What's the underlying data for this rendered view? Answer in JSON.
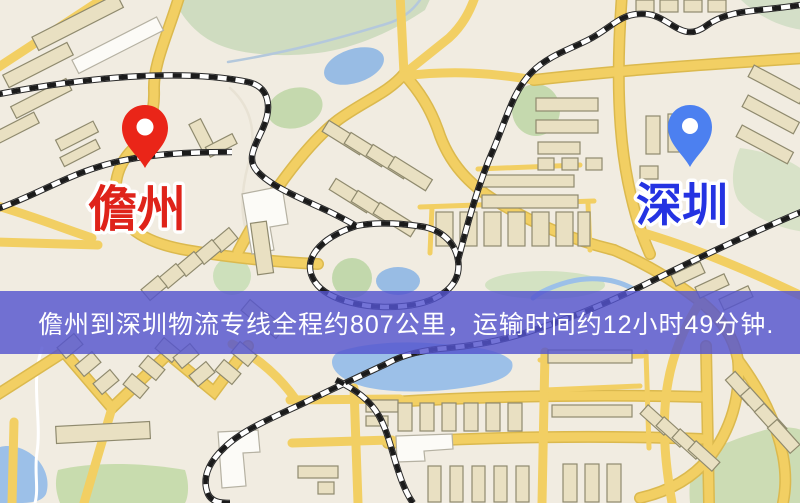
{
  "banner": {
    "text": "儋州到深圳物流专线全程约807公里，运输时间约12小时49分钟.",
    "background_color": "#5454ce",
    "text_color": "#ffffff"
  },
  "map": {
    "origin_label": "儋州",
    "destination_label": "深圳",
    "origin_label_color": "#df231a",
    "destination_label_color": "#2433e2",
    "origin_pin_color": "#ea2518",
    "destination_pin_color": "#4c80f0",
    "route": {
      "origin": "儋州",
      "destination": "深圳",
      "distance_km": 807,
      "duration_hours": 12,
      "duration_minutes": 49
    }
  }
}
